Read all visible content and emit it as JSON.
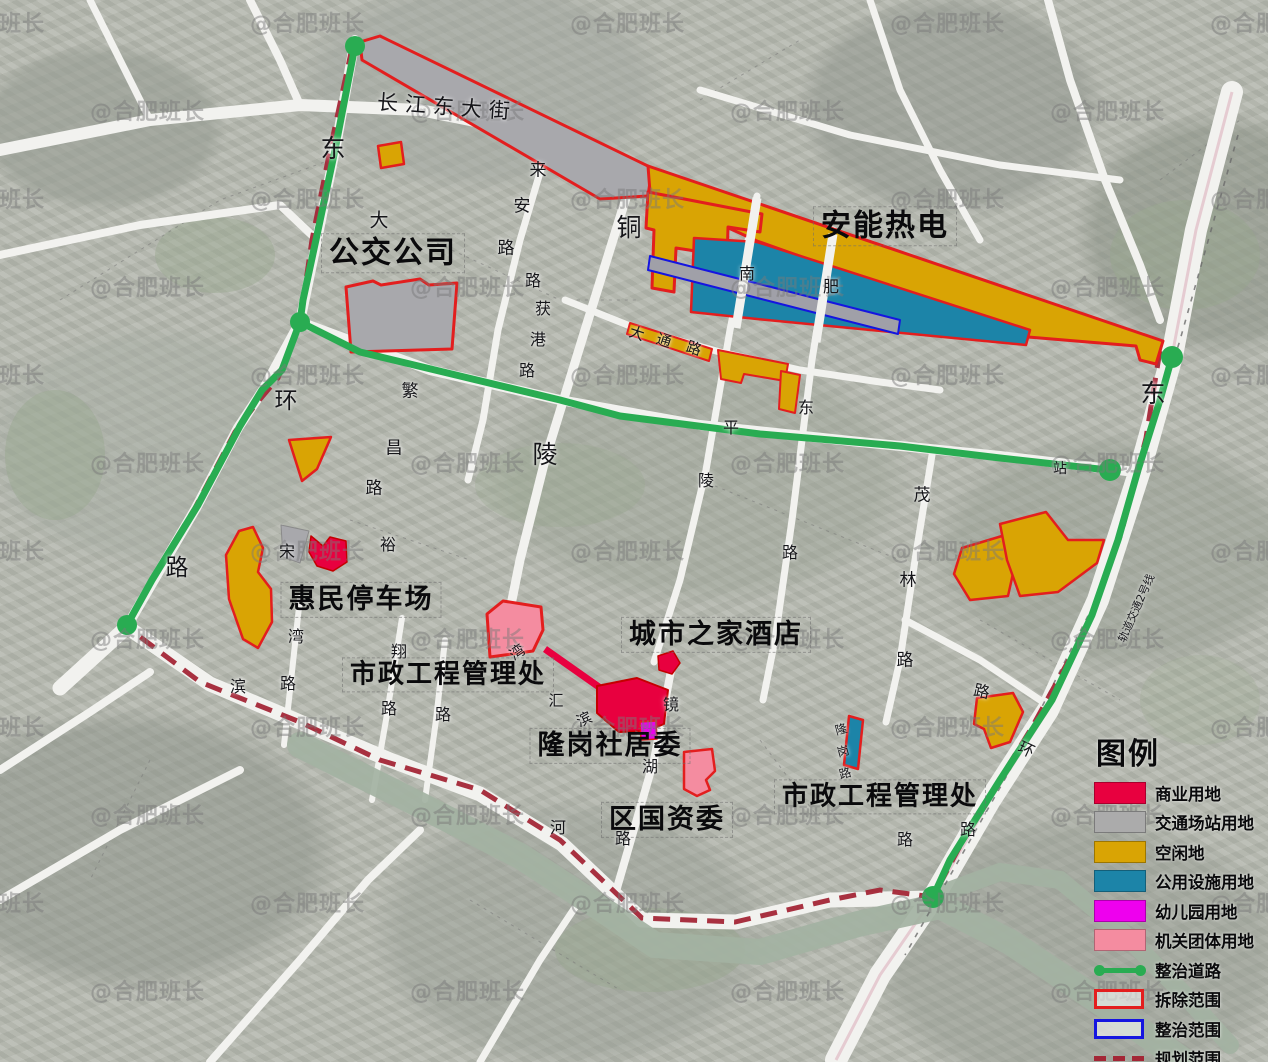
{
  "map": {
    "watermark_text": "@合肥班长",
    "area_labels": [
      {
        "id": "bus-company",
        "text": "公交公司",
        "x": 393,
        "y": 253,
        "size": 30
      },
      {
        "id": "anneng-thermal",
        "text": "安能热电",
        "x": 885,
        "y": 226,
        "size": 30
      },
      {
        "id": "huimin-parking",
        "text": "惠民停车场",
        "x": 361,
        "y": 600,
        "size": 27
      },
      {
        "id": "municipal-eng-office-1",
        "text": "市政工程管理处",
        "x": 448,
        "y": 675,
        "size": 26
      },
      {
        "id": "city-home-hotel",
        "text": "城市之家酒店",
        "x": 716,
        "y": 635,
        "size": 27
      },
      {
        "id": "longgang-committee",
        "text": "隆岗社居委",
        "x": 610,
        "y": 746,
        "size": 27
      },
      {
        "id": "district-sasac",
        "text": "区国资委",
        "x": 667,
        "y": 820,
        "size": 27
      },
      {
        "id": "municipal-eng-office-2",
        "text": "市政工程管理处",
        "x": 880,
        "y": 797,
        "size": 26
      }
    ],
    "road_labels": [
      {
        "text": "长江东大街",
        "x": 447,
        "y": 106,
        "size": 21,
        "rot": 4,
        "ls": 7
      },
      {
        "text": "东",
        "x": 333,
        "y": 147,
        "size": 25
      },
      {
        "text": "大",
        "x": 379,
        "y": 219,
        "size": 19
      },
      {
        "text": "来",
        "x": 538,
        "y": 168,
        "size": 17
      },
      {
        "text": "安",
        "x": 522,
        "y": 204,
        "size": 17
      },
      {
        "text": "路",
        "x": 506,
        "y": 246,
        "size": 17
      },
      {
        "text": "路",
        "x": 533,
        "y": 279,
        "size": 16
      },
      {
        "text": "获",
        "x": 543,
        "y": 307,
        "size": 16
      },
      {
        "text": "港",
        "x": 538,
        "y": 338,
        "size": 16
      },
      {
        "text": "路",
        "x": 527,
        "y": 369,
        "size": 16
      },
      {
        "text": "铜",
        "x": 629,
        "y": 226,
        "size": 25
      },
      {
        "text": "陵",
        "x": 545,
        "y": 453,
        "size": 25
      },
      {
        "text": "南",
        "x": 747,
        "y": 272,
        "size": 16
      },
      {
        "text": "肥",
        "x": 831,
        "y": 285,
        "size": 16
      },
      {
        "text": "东",
        "x": 806,
        "y": 406,
        "size": 16
      },
      {
        "text": "平",
        "x": 731,
        "y": 426,
        "size": 16
      },
      {
        "text": "陵",
        "x": 706,
        "y": 479,
        "size": 16
      },
      {
        "text": "路",
        "x": 790,
        "y": 551,
        "size": 16
      },
      {
        "text": "大",
        "x": 637,
        "y": 333,
        "size": 15,
        "rot": 18
      },
      {
        "text": "通",
        "x": 664,
        "y": 340,
        "size": 15,
        "rot": 18
      },
      {
        "text": "路",
        "x": 694,
        "y": 348,
        "size": 15,
        "rot": 18
      },
      {
        "text": "环",
        "x": 286,
        "y": 398,
        "size": 23
      },
      {
        "text": "路",
        "x": 177,
        "y": 565,
        "size": 23
      },
      {
        "text": "繁",
        "x": 410,
        "y": 389,
        "size": 17
      },
      {
        "text": "昌",
        "x": 394,
        "y": 446,
        "size": 17
      },
      {
        "text": "路",
        "x": 374,
        "y": 486,
        "size": 17
      },
      {
        "text": "裕",
        "x": 388,
        "y": 543,
        "size": 16
      },
      {
        "text": "宋",
        "x": 287,
        "y": 550,
        "size": 16
      },
      {
        "text": "湾",
        "x": 296,
        "y": 635,
        "size": 16
      },
      {
        "text": "路",
        "x": 288,
        "y": 682,
        "size": 16
      },
      {
        "text": "滨",
        "x": 238,
        "y": 685,
        "size": 16
      },
      {
        "text": "翔",
        "x": 399,
        "y": 650,
        "size": 16
      },
      {
        "text": "路",
        "x": 389,
        "y": 707,
        "size": 16
      },
      {
        "text": "路",
        "x": 443,
        "y": 713,
        "size": 16
      },
      {
        "text": "湾",
        "x": 517,
        "y": 652,
        "size": 15,
        "rot": -35
      },
      {
        "text": "汇",
        "x": 556,
        "y": 700,
        "size": 15
      },
      {
        "text": "滨",
        "x": 584,
        "y": 719,
        "size": 15,
        "rot": -25
      },
      {
        "text": "镜",
        "x": 671,
        "y": 703,
        "size": 16
      },
      {
        "text": "湖",
        "x": 650,
        "y": 765,
        "size": 16
      },
      {
        "text": "路",
        "x": 623,
        "y": 837,
        "size": 16
      },
      {
        "text": "河",
        "x": 558,
        "y": 826,
        "size": 16
      },
      {
        "text": "茂",
        "x": 922,
        "y": 493,
        "size": 17
      },
      {
        "text": "林",
        "x": 908,
        "y": 578,
        "size": 17
      },
      {
        "text": "路",
        "x": 905,
        "y": 658,
        "size": 17
      },
      {
        "text": "路",
        "x": 982,
        "y": 690,
        "size": 16,
        "rot": 12
      },
      {
        "text": "环",
        "x": 1027,
        "y": 748,
        "size": 16,
        "rot": 25
      },
      {
        "text": "路",
        "x": 968,
        "y": 828,
        "size": 16
      },
      {
        "text": "路",
        "x": 905,
        "y": 838,
        "size": 16
      },
      {
        "text": "站",
        "x": 1060,
        "y": 468,
        "size": 14
      },
      {
        "text": "东",
        "x": 1153,
        "y": 392,
        "size": 25
      },
      {
        "text": "隆",
        "x": 841,
        "y": 729,
        "size": 12,
        "rot": -15
      },
      {
        "text": "岗",
        "x": 843,
        "y": 751,
        "size": 12,
        "rot": -15
      },
      {
        "text": "路",
        "x": 845,
        "y": 773,
        "size": 12,
        "rot": -15
      },
      {
        "text": "轨道交通2号线",
        "x": 1136,
        "y": 608,
        "size": 11,
        "rot": -66
      }
    ]
  },
  "legend": {
    "title": "图例",
    "items": [
      {
        "label": "商业用地",
        "type": "fill",
        "color": "#E8003F"
      },
      {
        "label": "交通场站用地",
        "type": "fill",
        "color": "#ABABAB"
      },
      {
        "label": "空闲地",
        "type": "fill",
        "color": "#D9A404"
      },
      {
        "label": "公用设施用地",
        "type": "fill",
        "color": "#1C84A8"
      },
      {
        "label": "幼儿园用地",
        "type": "fill",
        "color": "#EE00EE"
      },
      {
        "label": "机关团体用地",
        "type": "fill",
        "color": "#F48CA0"
      },
      {
        "label": "整治道路",
        "type": "line",
        "color": "#29AC52"
      },
      {
        "label": "拆除范围",
        "type": "outline",
        "color": "#E31E1E"
      },
      {
        "label": "整治范围",
        "type": "outline",
        "color": "#1515E0"
      },
      {
        "label": "规划范围",
        "type": "dash",
        "color": "#A32636"
      }
    ]
  },
  "colors": {
    "renovation_road_green": "#29AC52",
    "planning_boundary_red": "#A32636",
    "demolition_outline_red": "#E31E1E",
    "road_white": "#F2F2EF",
    "river_gray_green": "#A3B2A2"
  }
}
